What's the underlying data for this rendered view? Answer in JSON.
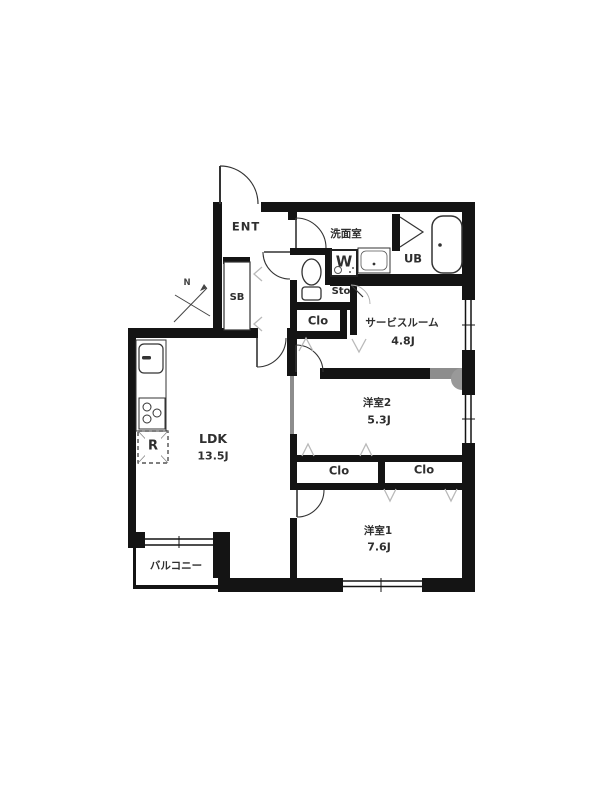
{
  "meta": {
    "type": "floor-plan",
    "colors": {
      "wall": "#141414",
      "line": "#333333",
      "gray_wall": "#8d8d8d",
      "chevron": "#b9b9b9",
      "text": "#2f2f2f"
    }
  },
  "rooms": {
    "entrance": {
      "label": "ENT"
    },
    "washroom": {
      "label": "洗面室"
    },
    "unit_bath": {
      "label": "UB"
    },
    "washer": {
      "label": "W"
    },
    "storage": {
      "label": "Sto"
    },
    "closet_hall": {
      "label": "Clo"
    },
    "service_room": {
      "label": "サービスルーム",
      "size": "4.8J"
    },
    "shoe_box": {
      "label": "SB"
    },
    "ldk": {
      "label": "LDK",
      "size": "13.5J"
    },
    "refrigerator": {
      "label": "R"
    },
    "room2": {
      "label": "洋室2",
      "size": "5.3J"
    },
    "closet1": {
      "label": "Clo"
    },
    "closet2": {
      "label": "Clo"
    },
    "room1": {
      "label": "洋室1",
      "size": "7.6J"
    },
    "balcony": {
      "label": "バルコニー"
    },
    "compass": {
      "label": "N"
    }
  }
}
